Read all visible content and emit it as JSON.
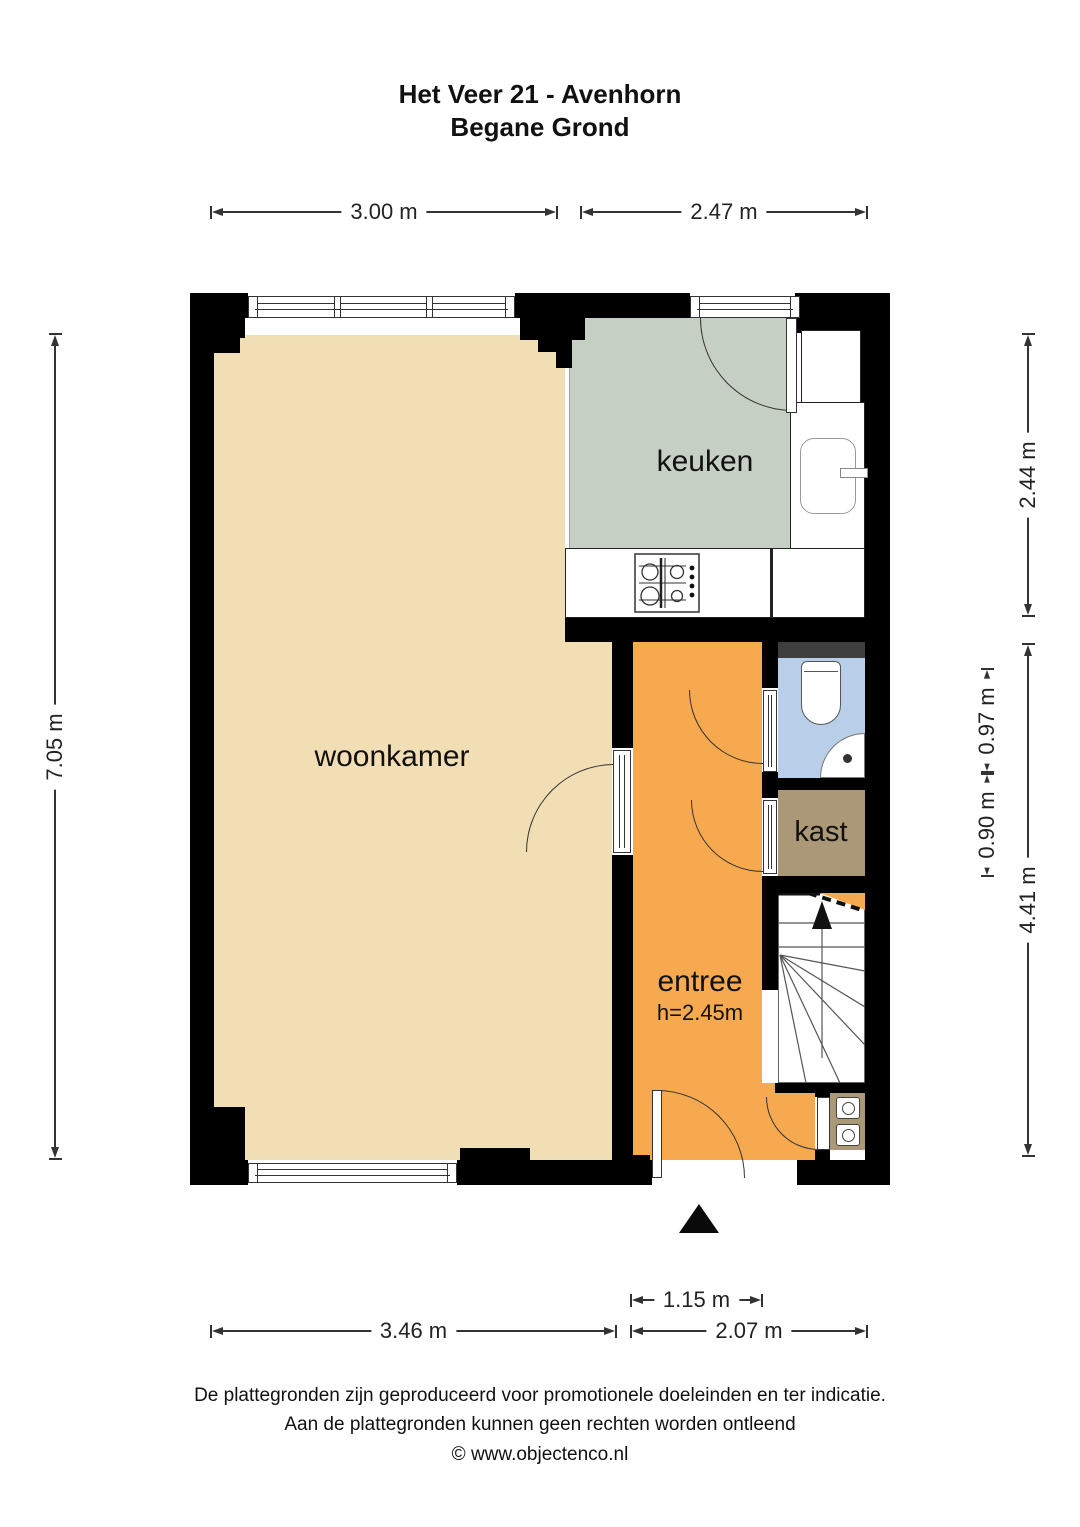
{
  "title": {
    "line1": "Het Veer 21 - Avenhorn",
    "line2": "Begane Grond"
  },
  "rooms": {
    "keuken": {
      "label": "keuken"
    },
    "woonkamer": {
      "label": "woonkamer"
    },
    "entree": {
      "label": "entree",
      "height_note": "h=2.45m"
    },
    "kast": {
      "label": "kast"
    }
  },
  "dimensions": {
    "top": [
      "3.00 m",
      "2.47 m"
    ],
    "left": [
      "7.05 m"
    ],
    "right": [
      "2.44 m",
      "0.97 m",
      "0.90 m",
      "4.41 m"
    ],
    "bottom": [
      "3.46 m",
      "1.15 m",
      "2.07 m"
    ]
  },
  "footer": {
    "line1": "De plattegronden zijn geproduceerd voor promotionele doeleinden en ter indicatie.",
    "line2": "Aan de plattegronden kunnen geen rechten worden ontleend",
    "line3": "© www.objectenco.nl"
  },
  "colors": {
    "woonkamer": "#F2DEB4",
    "keuken": "#C6CFC3",
    "entree": "#F6A94E",
    "kast": "#AB9877",
    "meterkast": "#AB9877",
    "toilet": "#B9CFE9",
    "duct": "#3F3F3F",
    "wall": "#000000"
  }
}
